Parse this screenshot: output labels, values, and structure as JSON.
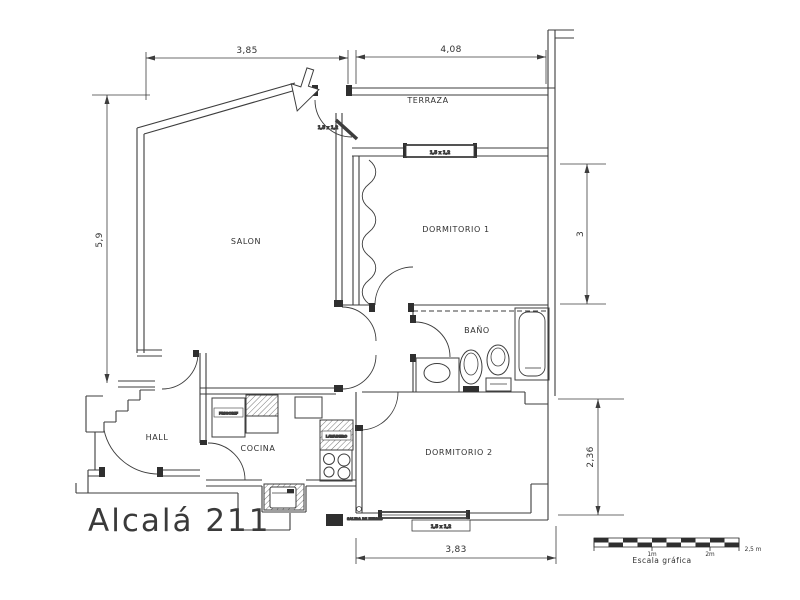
{
  "drawing": {
    "project_title": "Alcalá 211",
    "rooms": {
      "terraza": "TERRAZA",
      "salon": "SALON",
      "dormitorio1": "DORMITORIO 1",
      "bano": "BAÑO",
      "dormitorio2": "DORMITORIO 2",
      "hall": "HALL",
      "cocina": "COCINA"
    },
    "kitchen": {
      "fridge_label": "FRIGORIF",
      "laundry_label": "LAVADERO",
      "smoke_outlet_label": "SALIDA DE HUMOS"
    },
    "openings": {
      "terrace_door_tag": "1,5 x 1,2",
      "window_dorm1_tag": "1,5 x 1,2",
      "window_dorm2_tag": "1,5 x 1,2"
    },
    "dimensions": {
      "top_left": "3,85",
      "top_right": "4,08",
      "left": "5,9",
      "right_upper": "3",
      "right_lower": "2,36",
      "bottom": "3,83"
    },
    "scale_bar": {
      "title": "Escala gráfica",
      "tick_1m": "1m",
      "tick_2m": "2m",
      "tick_end": "2,5 m"
    },
    "colors": {
      "line": "#3d3d3d",
      "dark_fill": "#2f2f2f",
      "background": "#ffffff"
    }
  }
}
